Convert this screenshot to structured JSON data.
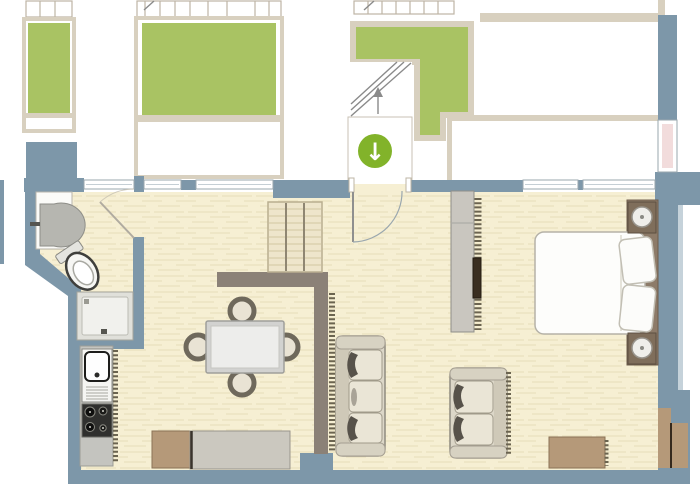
{
  "plan": {
    "kind": "apartment-floor-plan",
    "visible_text": "none"
  },
  "icons": {
    "entrance_arrow": "↓"
  },
  "colors": {
    "wall": "#7d97a9",
    "wall_light_edge": "#c5d2da",
    "floor": "#f6efd3",
    "green": "#a9c363",
    "frame": "#d8d0bf",
    "accent": "#82b32a",
    "partition": "#8b8177",
    "tan": "#b59979",
    "headboard": "#8d7b69",
    "nightstand": "#7f6e5b",
    "pink": "#f2dcdc",
    "counter": "#c4c4bf",
    "sofa": "#dcd7c8",
    "white": "#ffffff"
  }
}
